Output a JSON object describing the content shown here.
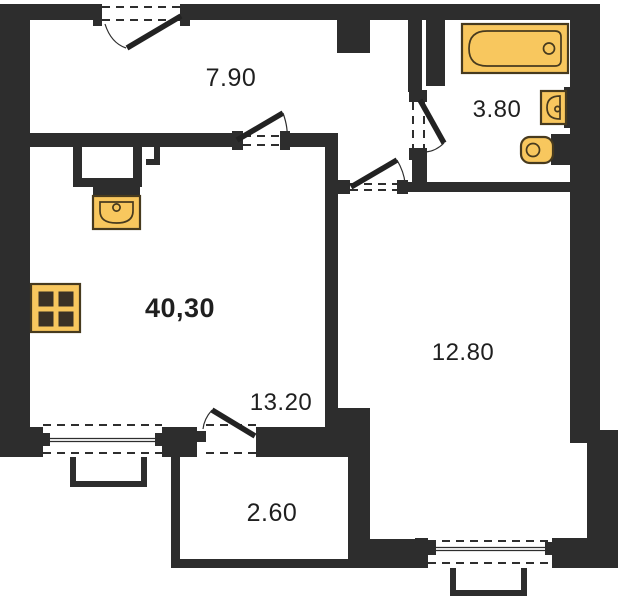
{
  "plan": {
    "type": "apartment-floor-plan",
    "total_area_label": "40,30",
    "rooms": [
      {
        "id": "hallway",
        "area_label": "7.90"
      },
      {
        "id": "bathroom",
        "area_label": "3.80"
      },
      {
        "id": "living-kitchen",
        "area_label": "13.20"
      },
      {
        "id": "bedroom",
        "area_label": "12.80"
      },
      {
        "id": "balcony",
        "area_label": "2.60"
      }
    ],
    "fixtures": [
      "bathtub",
      "washbasin",
      "toilet",
      "kitchen-sink",
      "stove",
      "ventilation-shaft"
    ],
    "colors": {
      "wall": "#2d2d2d",
      "fixture_fill": "#f8c75e",
      "fixture_stroke": "#473a1e",
      "line": "#2e2e2e",
      "label": "#1f1f1f",
      "background": "#ffffff"
    }
  }
}
